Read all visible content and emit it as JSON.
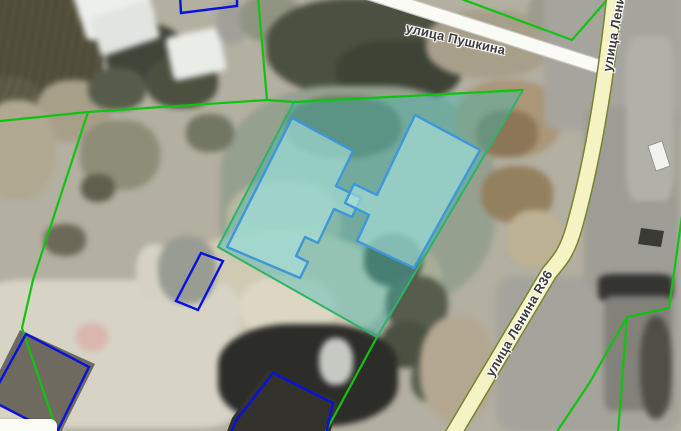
{
  "map": {
    "street_labels": {
      "pushkina": "улица Пушкина",
      "lenina": "улица Ленина",
      "lenina_r36": "улица Ленина R36"
    },
    "colors": {
      "cadastral-green": "#0fc40f",
      "building-outline-blue": "#0712dd",
      "parcel-stroke": "#2db368",
      "parcel-fill": "rgba(64,185,178,0.42)",
      "building-fill": "rgba(173,228,222,0.6)",
      "building-stroke": "#3e97d9",
      "road-white-fill": "#fbfbf6",
      "road-white-casing": "#c6c6bf",
      "road-yellow-fill": "#f5f2c3",
      "road-yellow-casing": "#77842f",
      "label-color": "#3b3b3b"
    },
    "features": {
      "selected_parcel": {
        "points": "294,102 523,90 377,337 218,247"
      },
      "parcel_top_edge": {
        "d": "M294,102 L523,90"
      },
      "building_left": {
        "points": "292,118 353,151 336,186 361,198 352,217 334,209 318,243 305,237 296,256 308,262 300,278 227,247"
      },
      "building_right": {
        "points": "415,115 480,150 414,268 357,241 369,215 345,203 354,184 377,195"
      },
      "outline_top": {
        "points": "180,-4 181,13 237,6 237,-4"
      },
      "outline_shed": {
        "points": "201,253 223,261 198,310 176,301"
      },
      "outline_sw": {
        "points": "26,334 89,367 56,434 -10,400"
      },
      "outline_south": {
        "points": "273,373 333,403 326,434 231,434 235,422"
      },
      "roof_sw": {
        "points": "20,330 95,364 60,434 -14,398"
      },
      "roof_south": {
        "points": "268,370 338,402 330,434 226,434 232,418"
      },
      "boundary_west_road": {
        "d": "M0,121 L88,112 L267,100 L294,102"
      },
      "boundary_north_stub": {
        "d": "M258,-3 L267,100"
      },
      "boundary_west_diag": {
        "d": "M88,112 L33,280 L22,328 L57,431"
      },
      "boundary_ne": {
        "d": "M456,-3 L572,40 L606,1"
      },
      "boundary_east": {
        "d": "M682,216 L669,308 L627,317 L618,433"
      },
      "boundary_east_branch": {
        "d": "M627,317 L590,382 L556,433"
      },
      "boundary_south_stub": {
        "d": "M377,337 L325,433"
      },
      "road_pushkina": {
        "d": "M366,-8 L604,68"
      },
      "road_lenina": {
        "d": "M615,-6 C608,60 596,150 574,228 C567,252 561,259 549,273 L452,436"
      },
      "car_white": {
        "points": "648,146 662,141 670,166 656,171"
      },
      "car_dark": {
        "points": "641,228 664,231 661,247 638,244"
      }
    }
  }
}
